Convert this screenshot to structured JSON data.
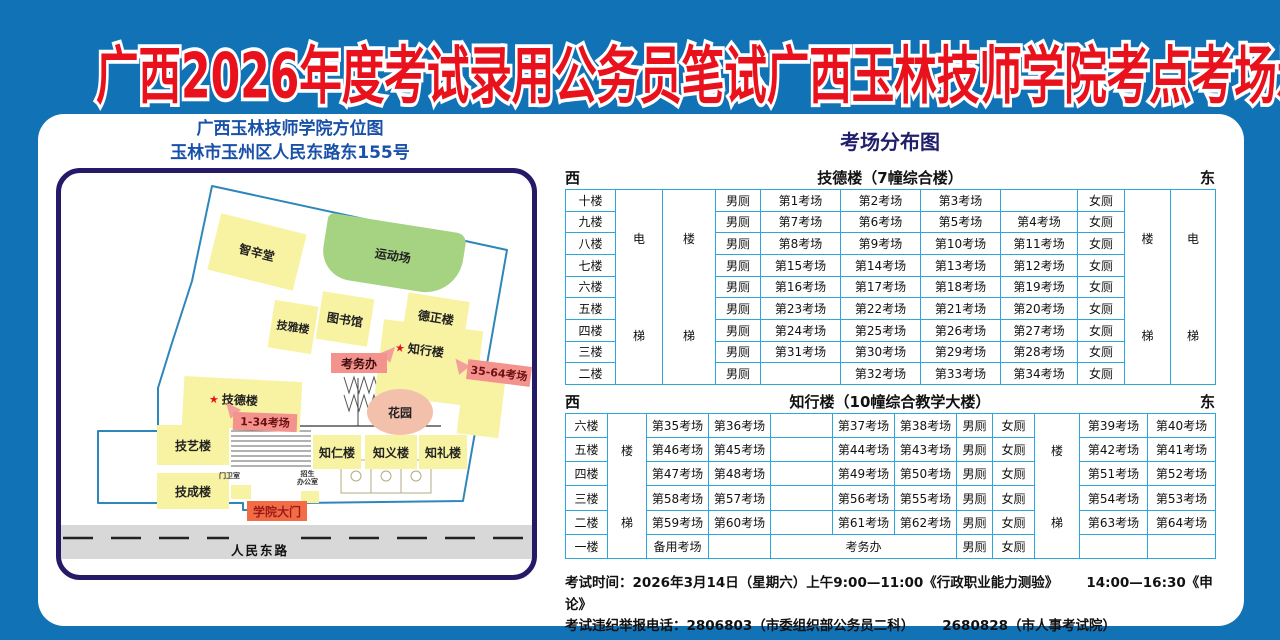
{
  "title": "广西2026年度考试录用公务员笔试广西玉林技师学院考点考场示意图",
  "map": {
    "title_line1": "广西玉林技师学院方位图",
    "title_line2": "玉林市玉州区人民东路东155号",
    "star": "★",
    "buildings": {
      "zhixintang": "智辛堂",
      "yundongchang": "运动场",
      "jiyalou": "技雅楼",
      "tushuguan": "图书馆",
      "dezhenglou": "德正楼",
      "zhixinglou": "知行楼",
      "jidelou": "技德楼",
      "jiyilou": "技艺楼",
      "zhirenlou": "知仁楼",
      "zhiyilou": "知义楼",
      "zhililou": "知礼楼",
      "jichenglou": "技成楼",
      "huayuan": "花园"
    },
    "labels": {
      "kaowuban": "考务办",
      "rooms_35_64": "35-64考场",
      "rooms_1_34": "1-34考场",
      "gate": "学院大门",
      "road": "人民东路",
      "guard_room": "门卫室",
      "admissions_line1": "招生",
      "admissions_line2": "办公室"
    }
  },
  "distribution": {
    "title": "考场分布图",
    "west": "西",
    "east": "东",
    "building1": {
      "name": "技德楼（7幢综合楼）",
      "shafts": {
        "left_elevator": [
          "电",
          "梯"
        ],
        "left_stairs": [
          "楼",
          "梯"
        ],
        "right_stairs": [
          "楼",
          "梯"
        ],
        "right_elevator": [
          "电",
          "梯"
        ]
      },
      "rows": [
        {
          "floor": "十楼",
          "cells": [
            "男厕",
            "第1考场",
            "第2考场",
            "第3考场",
            "",
            "女厕"
          ]
        },
        {
          "floor": "九楼",
          "cells": [
            "男厕",
            "第7考场",
            "第6考场",
            "第5考场",
            "第4考场",
            "女厕"
          ]
        },
        {
          "floor": "八楼",
          "cells": [
            "男厕",
            "第8考场",
            "第9考场",
            "第10考场",
            "第11考场",
            "女厕"
          ]
        },
        {
          "floor": "七楼",
          "cells": [
            "男厕",
            "第15考场",
            "第14考场",
            "第13考场",
            "第12考场",
            "女厕"
          ]
        },
        {
          "floor": "六楼",
          "cells": [
            "男厕",
            "第16考场",
            "第17考场",
            "第18考场",
            "第19考场",
            "女厕"
          ]
        },
        {
          "floor": "五楼",
          "cells": [
            "男厕",
            "第23考场",
            "第22考场",
            "第21考场",
            "第20考场",
            "女厕"
          ]
        },
        {
          "floor": "四楼",
          "cells": [
            "男厕",
            "第24考场",
            "第25考场",
            "第26考场",
            "第27考场",
            "女厕"
          ]
        },
        {
          "floor": "三楼",
          "cells": [
            "男厕",
            "第31考场",
            "第30考场",
            "第29考场",
            "第28考场",
            "女厕"
          ]
        },
        {
          "floor": "二楼",
          "cells": [
            "男厕",
            "",
            "第32考场",
            "第33考场",
            "第34考场",
            "女厕"
          ]
        }
      ]
    },
    "building2": {
      "name": "知行楼（10幢综合教学大楼）",
      "shafts": {
        "left_stairs": [
          "楼",
          "梯"
        ],
        "right_stairs": [
          "楼",
          "梯"
        ]
      },
      "rows": [
        {
          "floor": "六楼",
          "cells": [
            "第35考场",
            "第36考场",
            "",
            "第37考场",
            "第38考场",
            "男厕",
            "女厕"
          ],
          "right": [
            "第39考场",
            "第40考场"
          ]
        },
        {
          "floor": "五楼",
          "cells": [
            "第46考场",
            "第45考场",
            "",
            "第44考场",
            "第43考场",
            "男厕",
            "女厕"
          ],
          "right": [
            "第42考场",
            "第41考场"
          ]
        },
        {
          "floor": "四楼",
          "cells": [
            "第47考场",
            "第48考场",
            "",
            "第49考场",
            "第50考场",
            "男厕",
            "女厕"
          ],
          "right": [
            "第51考场",
            "第52考场"
          ]
        },
        {
          "floor": "三楼",
          "cells": [
            "第58考场",
            "第57考场",
            "",
            "第56考场",
            "第55考场",
            "男厕",
            "女厕"
          ],
          "right": [
            "第54考场",
            "第53考场"
          ]
        },
        {
          "floor": "二楼",
          "cells": [
            "第59考场",
            "第60考场",
            "",
            "第61考场",
            "第62考场",
            "男厕",
            "女厕"
          ],
          "right": [
            "第63考场",
            "第64考场"
          ]
        },
        {
          "floor": "一楼",
          "cells": [
            "备用考场",
            "",
            "考务办",
            "男厕",
            "女厕"
          ],
          "right": [
            "",
            ""
          ]
        }
      ]
    }
  },
  "footer": {
    "line1_part1": "考试时间：2026年3月14日（星期六）上午9:00—11:00《行政职业能力测验》",
    "line1_part2": "14:00—16:30《申论》",
    "line2_part1": "考试违纪举报电话：2806803（市委组织部公务员二科）",
    "line2_part2": "2680828（市人事考试院）"
  },
  "colors": {
    "background_blue": "#1173b6",
    "title_red": "#e8111c",
    "panel_white": "#ffffff",
    "map_border_navy": "#251a67",
    "header_blue": "#1a51a8",
    "table_border_blue": "#2ca7dd",
    "building_yellow": "#f8f3a3",
    "field_green": "#a6d381",
    "garden_pink": "#f3c0ab",
    "label_pink": "#f4928e",
    "gate_orange": "#f26d45",
    "road_gray": "#d8d8d8"
  }
}
